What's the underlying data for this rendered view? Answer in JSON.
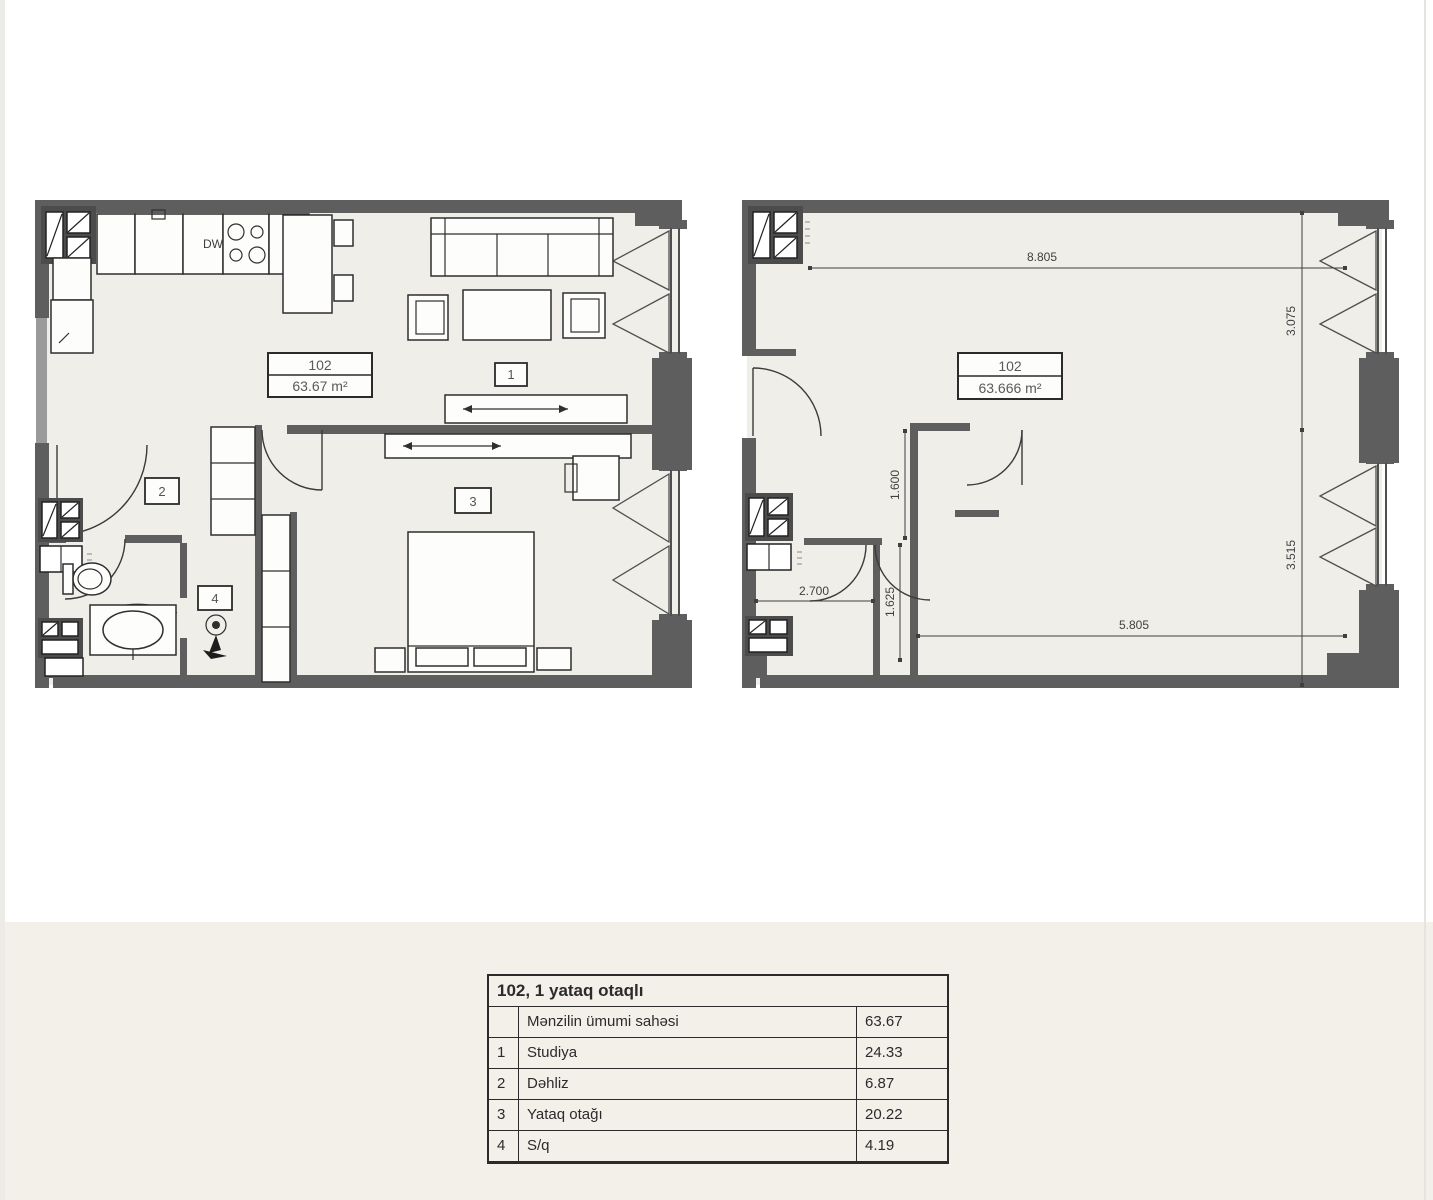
{
  "page": {
    "background_top": "#ffffff",
    "background_bottom": "#f3f0ea",
    "wall_color": "#5e5e5e",
    "floor_color": "#f0eee8"
  },
  "plans": {
    "left": {
      "unit_number": "102",
      "area": "63.67 m²",
      "room_tags": {
        "studio": "1",
        "hall": "2",
        "bedroom": "3",
        "bath": "4"
      },
      "appliance_labels": {
        "dishwasher": "DW"
      }
    },
    "right": {
      "unit_number": "102",
      "area": "63.666 m²",
      "dimensions": {
        "top": "8.805",
        "right_upper": "3.075",
        "right_lower": "3.515",
        "hall_height": "1.600",
        "hall_width": "2.700",
        "bath_height": "1.625",
        "bottom": "5.805"
      }
    }
  },
  "table": {
    "title": "102, 1 yataq otaqlı",
    "rows": [
      {
        "no": "",
        "name": "Mənzilin ümumi sahəsi",
        "area": "63.67"
      },
      {
        "no": "1",
        "name": "Studiya",
        "area": "24.33"
      },
      {
        "no": "2",
        "name": "Dəhliz",
        "area": "6.87"
      },
      {
        "no": "3",
        "name": "Yataq otağı",
        "area": "20.22"
      },
      {
        "no": "4",
        "name": "S/q",
        "area": "4.19"
      }
    ]
  }
}
